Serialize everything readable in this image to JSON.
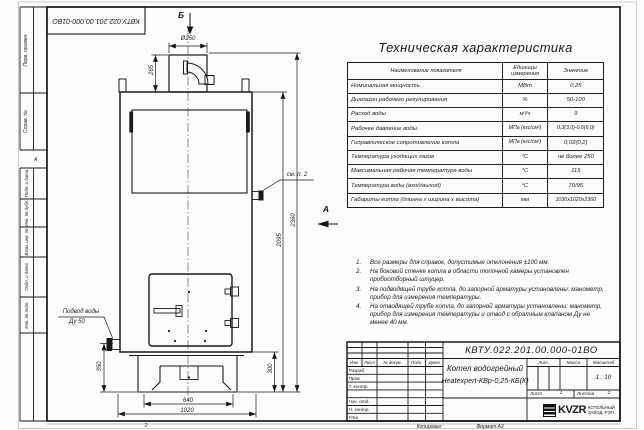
{
  "colors": {
    "ink": "#1a1a1a",
    "paper": "#fcfcfb"
  },
  "sheet": {
    "doc_number_stamp": "КВТУ.022.201.00.000-01ВО",
    "copied_label": "Копировал",
    "format_label": "Формат А3",
    "fold_mark_bottom": "2",
    "zone_mark_left": "А"
  },
  "margin_labels": [
    {
      "label": "Перв. примен."
    },
    {
      "label": "Справ. №"
    },
    {
      "label": "Подп. и дата"
    },
    {
      "label": "Инв. № дубл."
    },
    {
      "label": "Взам. инв. №"
    },
    {
      "label": "Подп. и дата"
    },
    {
      "label": "Инв. № подл."
    }
  ],
  "drawing": {
    "view_b_label": "Б",
    "view_a_label": "А",
    "see_note_label": "см. п. 2",
    "water_inlet_line1": "Подвод воды",
    "water_inlet_line2": "Ду 50",
    "dims": {
      "chimney_diameter": "Ø250",
      "chimney_height": "265",
      "total_height": "2360",
      "body_height": "2095",
      "base_height": "300",
      "inlet_height": "350",
      "base_width": "640",
      "total_width": "1020"
    }
  },
  "spec_table": {
    "title": "Техническая характеристика",
    "headers": [
      "Наименование показателя",
      "Единицы измерения",
      "Значение"
    ],
    "rows": [
      [
        "Номинальная мощность",
        "МВт",
        "0,25"
      ],
      [
        "Диапазон рабочего регулирования",
        "%",
        "50-100"
      ],
      [
        "Расход воды",
        "м³/ч",
        "9"
      ],
      [
        "Рабочее давление воды",
        "МПа (кгс/см²)",
        "0,3(3,0)-0,6(6,0)"
      ],
      [
        "Гидравлическое сопротивление котла",
        "МПа (кгс/см²)",
        "0,02(0,2)"
      ],
      [
        "Температура уходящих газов",
        "°С",
        "не более 250"
      ],
      [
        "Максимальная рабочая температура воды",
        "°С",
        "115"
      ],
      [
        "Температура воды (вход/выход)",
        "°С",
        "70/95"
      ],
      [
        "Габариты котла (длинна х ширина х высота)",
        "мм",
        "1030х1020х2360"
      ]
    ]
  },
  "notes": [
    {
      "num": "1.",
      "text": "Все размеры для справок, допустимые отклонения ±100 мм."
    },
    {
      "num": "2.",
      "text": "На боковой стенке котла в области топочной камеры установлен пробоотборный штуцер."
    },
    {
      "num": "3.",
      "text": "На подводящей трубе котла, до запорной арматуры установлены: манометр, прибор для измерения температуры."
    },
    {
      "num": "4.",
      "text": "На отводящей трубе котла, до запорной арматуры установлены: манометр, прибор для измерения температуры и отвод с обратным клапаном Ду не менее 40 мм."
    }
  ],
  "title_block": {
    "doc_number": "КВТУ.022.201.00.000-01ВО",
    "product_line1": "Котел водогрейный",
    "product_line2": "Heatexpert-КВр-0,25-КБ(К)",
    "rev_headers": [
      "Изм.",
      "Лист",
      "№ докум.",
      "Подп.",
      "Дата"
    ],
    "role_rows": [
      "Разраб.",
      "Пров.",
      "Т. контр.",
      "",
      "Нач. отд.",
      "Н. контр.",
      "Утв."
    ],
    "lit_label": "Лит.",
    "mass_label": "Масса",
    "scale_label": "Масштаб",
    "scale_value": "1 : 10",
    "sheet_label": "Лист",
    "sheet_value": "1",
    "sheets_label": "Листов",
    "sheets_value": "2",
    "company": {
      "logo_text": "KVZR",
      "line1": "КОТЕЛЬНЫЙ",
      "line2": "ЗАВОД, РЭП"
    }
  }
}
